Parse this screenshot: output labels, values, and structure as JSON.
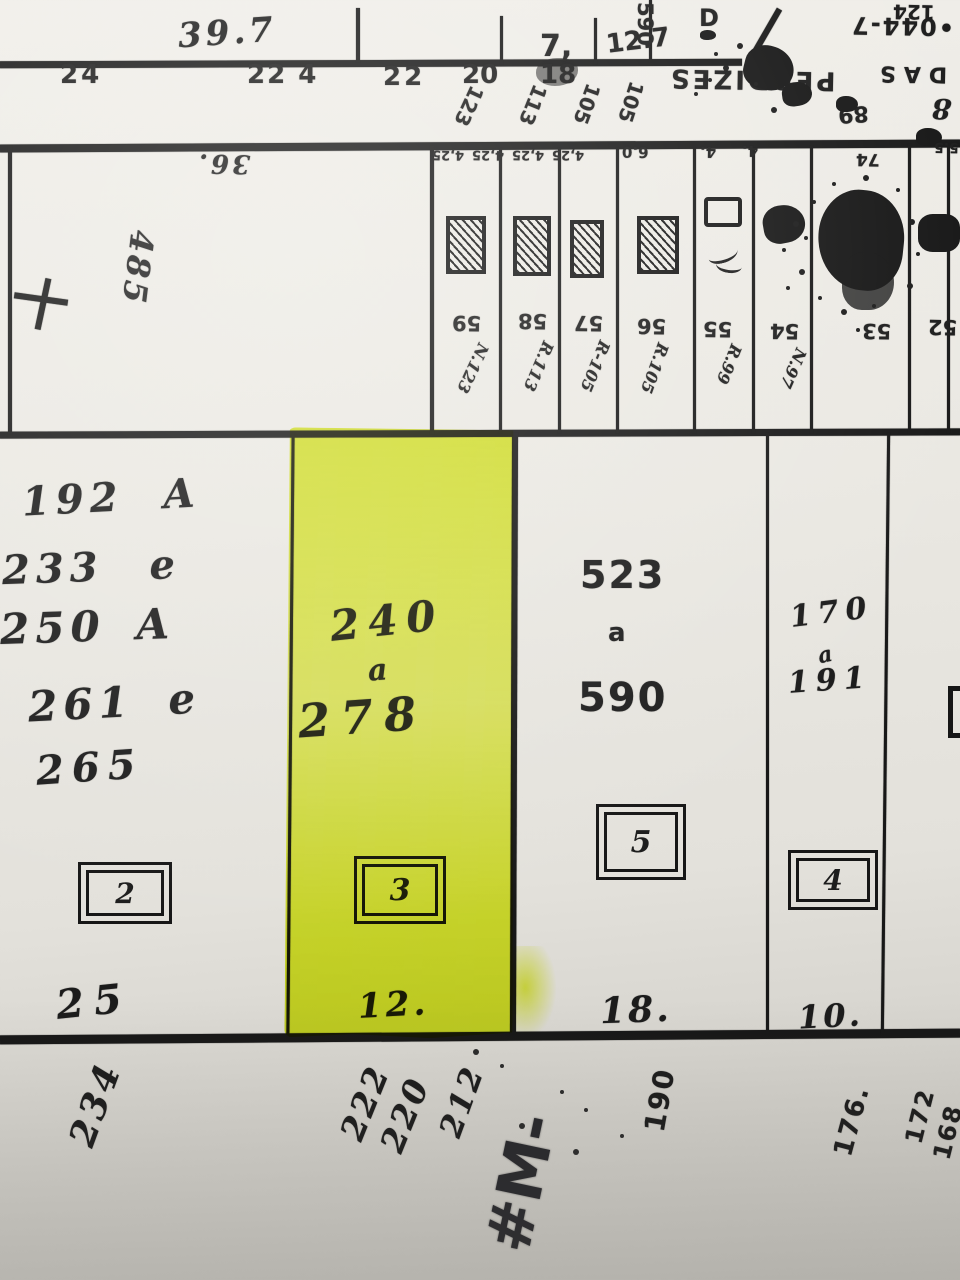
{
  "colors": {
    "paper": "#eae8e2",
    "ink": "#1c1c1c",
    "highlight": "#e4f233",
    "marker_ink": "#26262a"
  },
  "top_margin": {
    "depth_note": "39.7",
    "lot_width_7": "7,",
    "lot_width_127": "12.7",
    "house_590": "590",
    "d_mark": "D",
    "house_124": "124",
    "sheet_code": "•044-7",
    "street_word_das": "DAS",
    "street_word_perdizes": "PERDIZES"
  },
  "street_band": {
    "house_numbers": [
      "24",
      "22 4",
      "22",
      "20",
      "18"
    ],
    "side_refs": [
      "123",
      "113",
      "105",
      "105"
    ],
    "right_ref": "89",
    "right_hand_mark": "8"
  },
  "lot_strip": {
    "left_block": {
      "top_width": "36.",
      "side_code": "485"
    },
    "width_labels": [
      "4,25",
      "4,25",
      "4,25",
      "4,25",
      "6.0",
      "4.",
      "4.",
      "74",
      "5.5"
    ],
    "lots": [
      {
        "number": "59",
        "ref": "N.123"
      },
      {
        "number": "58",
        "ref": "R.113"
      },
      {
        "number": "57",
        "ref": "R-105"
      },
      {
        "number": "56",
        "ref": "R.105"
      },
      {
        "number": "55",
        "ref": "R.99"
      },
      {
        "number": "54",
        "ref": "N.97"
      },
      {
        "number": "53",
        "ref": ""
      },
      {
        "number": "52",
        "ref": ""
      }
    ]
  },
  "parcels": [
    {
      "lines": [
        "192 A",
        "233 e",
        "250 A",
        "261 e",
        "265"
      ],
      "block_number": "2",
      "frontage": "25"
    },
    {
      "from": "240",
      "conj": "a",
      "to": "278",
      "block_number": "3",
      "frontage": "12.",
      "highlighted": true
    },
    {
      "from": "523",
      "conj": "a",
      "to": "590",
      "block_number": "5",
      "frontage": "18."
    },
    {
      "from": "170",
      "conj": "a",
      "to": "191",
      "block_number": "4",
      "frontage": "10."
    }
  ],
  "bottom_band": {
    "house_numbers": [
      "234",
      "222",
      "220",
      "212",
      "190",
      "176.",
      "172",
      "168"
    ],
    "marker_note": "#M-"
  }
}
